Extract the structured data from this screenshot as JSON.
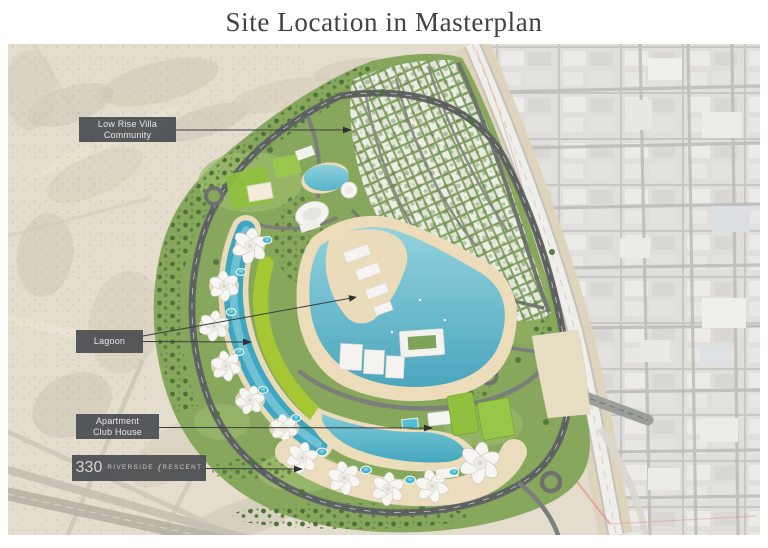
{
  "title": "Site Location in Masterplan",
  "map": {
    "labels": {
      "villa_line1": "Low Rise Villa",
      "villa_line2": "Community",
      "lagoon": "Lagoon",
      "club_line1": "Apartment",
      "club_line2": "Club House"
    },
    "brand": {
      "number": "330",
      "word1": "RIVERSIDE",
      "crescent": "(",
      "word2": "RESCENT"
    },
    "colors": {
      "label_bg": "#4a4e51",
      "lagoon_water": "#4ba6bd",
      "lawn_green": "#a6c832",
      "site_green": "#87a75d",
      "beach_sand": "#ecdcba",
      "desert": "#e4dccd",
      "boundary_pink": "#e59a90"
    }
  }
}
